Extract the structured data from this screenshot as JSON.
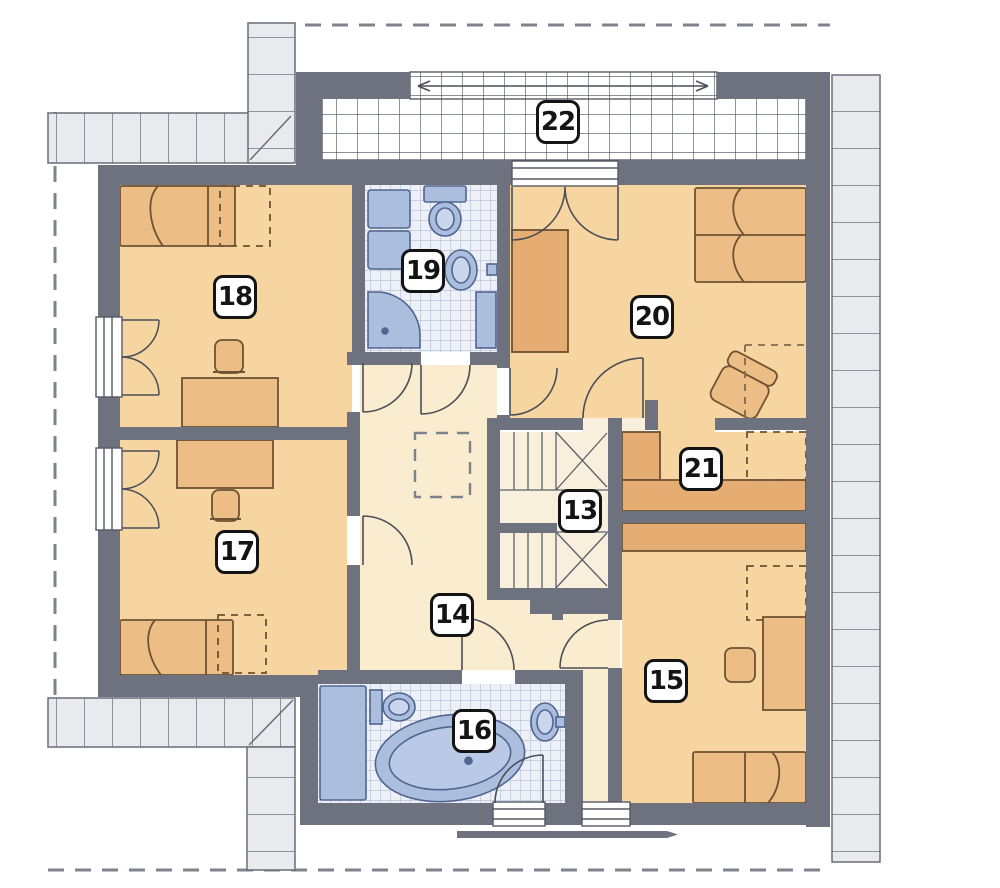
{
  "plan_title": "",
  "rooms": {
    "r13": "13",
    "r14": "14",
    "r15": "15",
    "r16": "16",
    "r17": "17",
    "r18": "18",
    "r19": "19",
    "r20": "20",
    "r21": "21",
    "r22": "22"
  },
  "palette": {
    "wall": "#6d727e",
    "room_floor": "#f6d5a0",
    "hall_floor": "#faecce",
    "stair_floor": "#f8efdd",
    "furniture": "#ecbe85",
    "wardrobe": "#e5ad72",
    "fixture_blue": "#abbede",
    "fixture_stroke": "#51658f",
    "bath_tile": "#edf0f7",
    "bath_tile_line": "#a6b0cd",
    "terrace_tile_line": "#4a4f58",
    "eave_fill": "#e8eaee",
    "outline": "#686d78",
    "roof_dash": "#7e838d"
  }
}
